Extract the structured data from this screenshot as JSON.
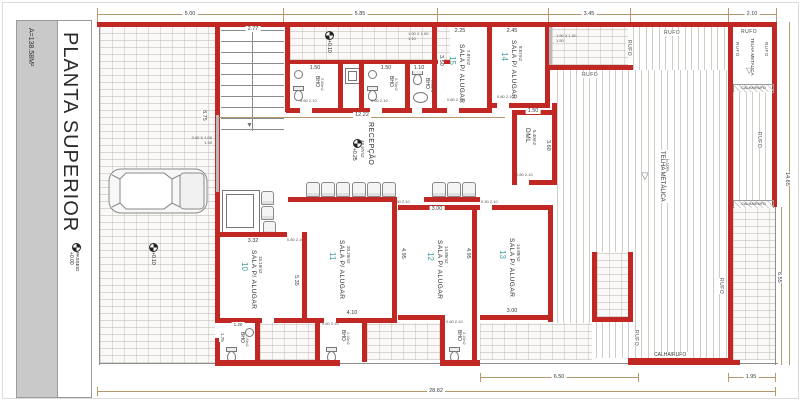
{
  "sheet": {
    "title": "PLANTA SUPERIOR",
    "area": "A=138.58M²"
  },
  "levels": {
    "passeio": {
      "value": "+0.00",
      "label": "PASSEIO"
    },
    "garage": "+0.10",
    "hall": "+0.10",
    "reception": "+0.25"
  },
  "reception": {
    "name": "RECEPÇÃO",
    "area": "48.97m2"
  },
  "rooms": {
    "r10": {
      "num": "10",
      "name": "SALA P/ ALUGAR",
      "area": "15.19m2"
    },
    "r11": {
      "num": "11",
      "name": "SALA P/ ALUGAR",
      "area": "20.29m2"
    },
    "r12": {
      "num": "12",
      "name": "SALA P/ ALUGAR",
      "area": "14.85m2"
    },
    "r13": {
      "num": "13",
      "name": "SALA P/ ALUGAR",
      "area": "14.88m2"
    },
    "r14": {
      "num": "14",
      "name": "SALA P/ ALUGAR",
      "area": "8.57m2"
    },
    "r15": {
      "num": "15",
      "name": "SALA P/ ALUGAR",
      "area": "7.87m2"
    },
    "dml": {
      "name": "DML",
      "area": "5.40m2"
    }
  },
  "bathrooms": {
    "label": "BHO",
    "areas": {
      "top1": "2.50m2",
      "top2": "2.76m2",
      "top3": "2.04m2",
      "bottom": "2.10m2"
    }
  },
  "roof": {
    "rufo": "RUFO",
    "calha_rufo": "CALHA/RUFO",
    "telha": "TELHA METÁLICA",
    "slope": "i=10%",
    "telha_box": "TELHA METALICA",
    "arrow": "▽"
  },
  "stairs": {
    "arrow": "▼"
  },
  "dims": {
    "top_parking": "5.00",
    "top_hall": "5.85",
    "top_terrace": "3.45",
    "top_box": "2.10",
    "stairs": "2.77",
    "r15_w": "2.25",
    "r14_w": "2.45",
    "bath1": "1.50",
    "bath2": "1.50",
    "bath3": "1.10",
    "bathrow": "12.22",
    "r15_h": "3.50",
    "dml_w": "1.50",
    "dml_h": "3.60",
    "left_wall": "8.75",
    "r10_w": "3.32",
    "r10_h": "5.35",
    "r11_h": "4.35",
    "r11_w": "4.10",
    "r12_h": "4.95",
    "r12_h2": "4.95",
    "r12_w": "3.00",
    "r13_w": "3.00",
    "bath_b_w": "1.20",
    "bath_b_h": "1.75",
    "bottom_mid": "6.50",
    "bottom_right": "1.95",
    "total": "28.82",
    "right_full": "14.65",
    "right_low": "6.55"
  },
  "doors": {
    "w080": "0.80",
    "w090": "0.90",
    "w060": "0.60",
    "h": "2.10"
  },
  "windows": {
    "w1": "1.50 X 1.00",
    "w1s": "1.50",
    "w2": "1.90 X 1.00",
    "w2s": "1.10",
    "w3": "3.00 X 1.00",
    "w3s": "1.50"
  },
  "colors": {
    "wall": "#c22823",
    "room_number": "#3d9f9f",
    "dim_line": "#b5986b",
    "title_bar": "#c9c9c9"
  }
}
